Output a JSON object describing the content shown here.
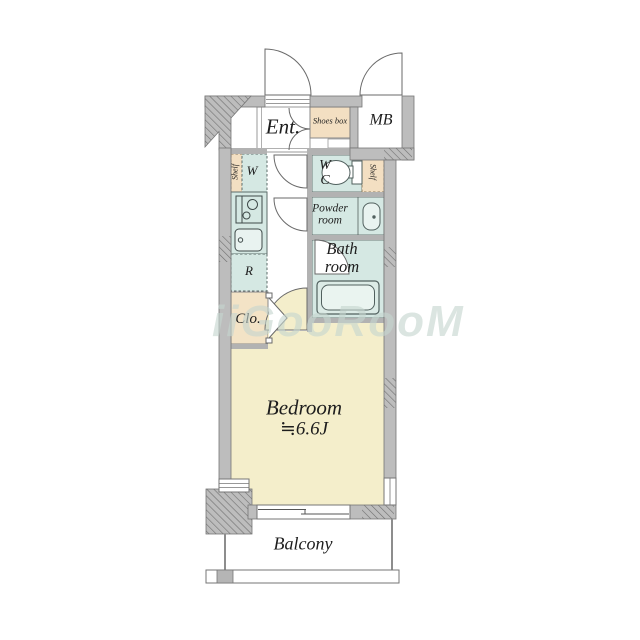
{
  "rooms": {
    "entrance": {
      "label": "Ent."
    },
    "shoes_box": {
      "label": "Shoes box"
    },
    "meter_box": {
      "label": "MB"
    },
    "shelf_left": {
      "label": "Shelf"
    },
    "washing_machine": {
      "label": "W"
    },
    "water_closet": {
      "line1": "W",
      "line2": "C"
    },
    "shelf_right": {
      "label": "Shelf"
    },
    "powder_room": {
      "line1": "Powder",
      "line2": "room"
    },
    "bath_room": {
      "line1": "Bath",
      "line2": "room"
    },
    "refrigerator": {
      "label": "R"
    },
    "closet": {
      "label": "Clo."
    },
    "bedroom": {
      "line1": "Bedroom",
      "line2": "≒6.6J"
    },
    "balcony": {
      "label": "Balcony"
    }
  },
  "watermark": "iiGooRooM",
  "colors": {
    "wall": "#bdbdbd",
    "wall_edge": "#767676",
    "wet_area_fill": "#d5e8e3",
    "storage_fill": "#f3dfc2",
    "bedroom_fill": "#f4eecb",
    "fixture_stroke": "#51605e",
    "text": "#1d1d1d",
    "watermark_color": "#c6d6cf"
  }
}
